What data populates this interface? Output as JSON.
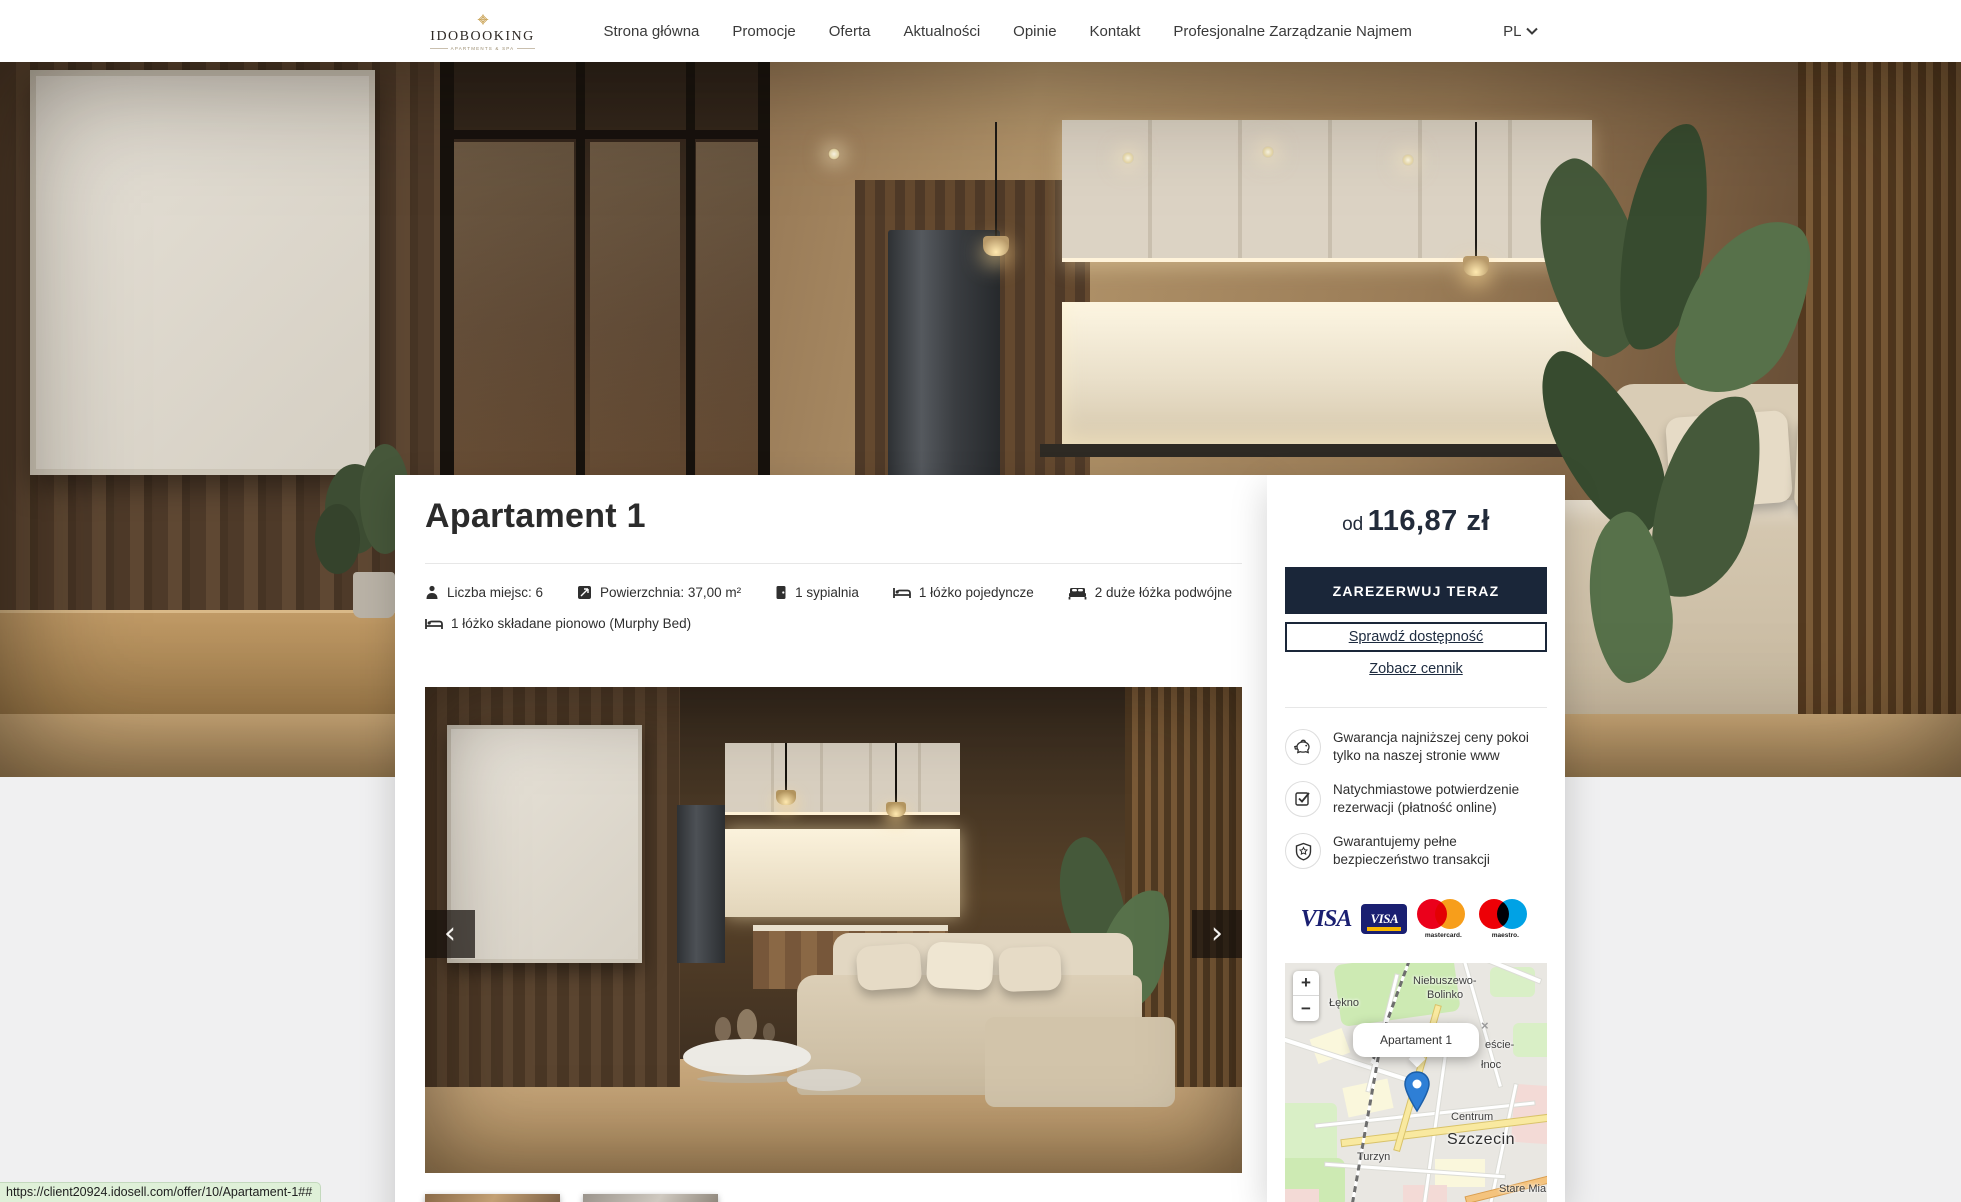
{
  "header": {
    "logo": {
      "brand": "IDOBOOKING",
      "tagline": "APARTMENTS & SPA"
    },
    "nav": [
      {
        "label": "Strona główna"
      },
      {
        "label": "Promocje"
      },
      {
        "label": "Oferta"
      },
      {
        "label": "Aktualności"
      },
      {
        "label": "Opinie"
      },
      {
        "label": "Kontakt"
      },
      {
        "label": "Profesjonalne Zarządzanie Najmem"
      }
    ],
    "language": {
      "code": "PL"
    }
  },
  "listing": {
    "title": "Apartament 1",
    "features": [
      {
        "icon": "person-icon",
        "label": "Liczba miejsc: 6"
      },
      {
        "icon": "area-icon",
        "label": "Powierzchnia: 37,00 m²"
      },
      {
        "icon": "door-icon",
        "label": "1 sypialnia"
      },
      {
        "icon": "single-bed-icon",
        "label": "1 łóżko pojedyncze"
      },
      {
        "icon": "double-bed-icon",
        "label": "2 duże łóżka podwójne"
      },
      {
        "icon": "murphy-bed-icon",
        "label": "1 łóżko składane pionowo (Murphy Bed)"
      }
    ],
    "carousel": {
      "prev": "‹",
      "next": "›"
    }
  },
  "booking": {
    "price_prefix": "od",
    "price": "116,87 zł",
    "reserve_button": "ZAREZERWUJ TERAZ",
    "check_availability": "Sprawdź dostępność",
    "see_prices": "Zobacz cennik",
    "guarantees": [
      {
        "icon": "piggy-bank-icon",
        "text": "Gwarancja najniższej ceny pokoi tylko na naszej stronie www"
      },
      {
        "icon": "checkbox-icon",
        "text": "Natychmiastowe potwierdzenie rezerwacji (płatność online)"
      },
      {
        "icon": "shield-icon",
        "text": "Gwarantujemy pełne bezpieczeństwo transakcji"
      }
    ],
    "payments": {
      "visa": "VISA",
      "visa_electron": "VISA",
      "mastercard_label": "mastercard.",
      "maestro_label": "maestro."
    }
  },
  "map": {
    "zoom_in": "+",
    "zoom_out": "−",
    "popup_title": "Apartament 1",
    "popup_close": "×",
    "labels": {
      "lekno": "Łękno",
      "niebuszewo1": "Niebuszewo-",
      "niebuszewo2": "Bolinko",
      "srodmiescie1": "eście-",
      "srodmiescie2": "łnoc",
      "centrum": "Centrum",
      "city": "Szczecin",
      "turzyn": "Turzyn",
      "stare": "Stare Mia"
    }
  },
  "status_bar": {
    "url": "https://client20924.idosell.com/offer/10/Apartament-1##"
  },
  "colors": {
    "accent_navy": "#1a2639",
    "page_bg": "#f0f0f1",
    "gold": "#c9a254",
    "marker_blue": "#2e7fd6"
  }
}
